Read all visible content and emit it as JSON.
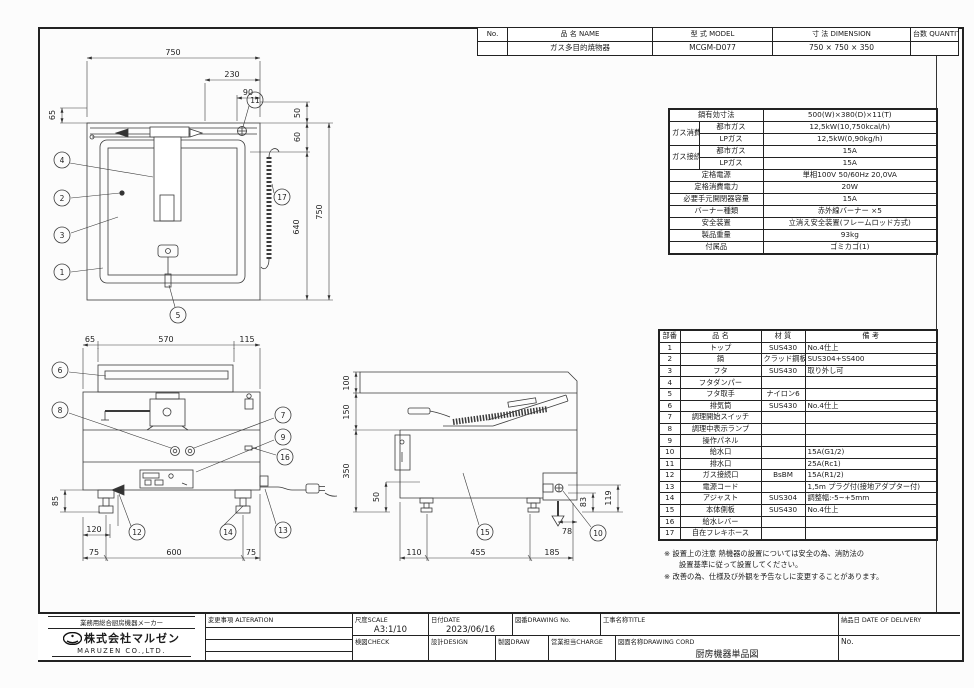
{
  "title_table": {
    "headers": {
      "no": "No.",
      "name": "品 名  NAME",
      "model": "型 式  MODEL",
      "dimension": "寸 法  DIMENSION",
      "quantity": "台数 QUANTITY"
    },
    "row": {
      "no": "",
      "name": "ガス多目的焼物器",
      "model": "MCGM-D077",
      "dimension": "750 × 750 × 350",
      "quantity": ""
    }
  },
  "spec": {
    "pan_size_label": "鍋有効寸法",
    "pan_size": "500(W)×380(D)×11(T)",
    "gas_consumption_label": "ガス消費量",
    "city_gas_label": "都市ガス",
    "lp_gas_label": "LPガス",
    "consumption_city": "12,5kW(10,750kcal/h)",
    "consumption_lp": "12,5kW(0,90kg/h)",
    "gas_connection_label": "ガス接続口",
    "connection_city_label": "都市ガス",
    "connection_lp_label": "LPガス",
    "connection_city": "15A",
    "connection_lp": "15A",
    "power_label": "定格電源",
    "power": "単相100V 50/60Hz 20,0VA",
    "power_consumption_label": "定格消費電力",
    "power_consumption": "20W",
    "breaker_label": "必要手元開閉器容量",
    "breaker": "15A",
    "burner_label": "バーナー種類",
    "burner": "赤外線バーナー ×5",
    "safety_label": "安全装置",
    "safety": "立消え安全装置(フレームロッド方式)",
    "weight_label": "製品重量",
    "weight": "93kg",
    "accessories_label": "付属品",
    "accessories": "ゴミカゴ(1)"
  },
  "parts": {
    "headers": {
      "no": "部番",
      "name": "品  名",
      "material": "材 質",
      "note": "備  考"
    },
    "rows": [
      {
        "no": "1",
        "name": "トップ",
        "material": "SUS430",
        "note": "No.4仕上"
      },
      {
        "no": "2",
        "name": "鍋",
        "material": "クラッド鋼板",
        "note": "SUS304+SS400"
      },
      {
        "no": "3",
        "name": "フタ",
        "material": "SUS430",
        "note": "取り外し可"
      },
      {
        "no": "4",
        "name": "フタダンパー",
        "material": "",
        "note": ""
      },
      {
        "no": "5",
        "name": "フタ取手",
        "material": "ナイロン6",
        "note": ""
      },
      {
        "no": "6",
        "name": "排気筒",
        "material": "SUS430",
        "note": "No.4仕上"
      },
      {
        "no": "7",
        "name": "調理開始スイッチ",
        "material": "",
        "note": ""
      },
      {
        "no": "8",
        "name": "調理中表示ランプ",
        "material": "",
        "note": ""
      },
      {
        "no": "9",
        "name": "操作パネル",
        "material": "",
        "note": ""
      },
      {
        "no": "10",
        "name": "給水口",
        "material": "",
        "note": "15A(G1/2)"
      },
      {
        "no": "11",
        "name": "排水口",
        "material": "",
        "note": "25A(Rc1)"
      },
      {
        "no": "12",
        "name": "ガス接続口",
        "material": "BsBM",
        "note": "15A(R1/2)"
      },
      {
        "no": "13",
        "name": "電源コード",
        "material": "",
        "note": "1,5m プラグ付(接地アダプター付)"
      },
      {
        "no": "14",
        "name": "アジャスト",
        "material": "SUS304",
        "note": "調整幅:-5~+5mm"
      },
      {
        "no": "15",
        "name": "本体側板",
        "material": "SUS430",
        "note": "No.4仕上"
      },
      {
        "no": "16",
        "name": "給水レバー",
        "material": "",
        "note": ""
      },
      {
        "no": "17",
        "name": "自在フレキホース",
        "material": "",
        "note": ""
      }
    ]
  },
  "notes": {
    "line1": "※ 設置上の注意 熱機器の設置については安全の為、消防法の",
    "line2": "設置基準に従って設置してください。",
    "line3": "※ 改善の為、仕様及び外観を予告なしに変更することがあります。"
  },
  "title_block": {
    "company_tagline": "業務用総合厨房機器メーカー",
    "company_name": "株式会社マルゼン",
    "company_name_en": "MARUZEN CO.,LTD.",
    "alteration_label": "変更事項  ALTERATION",
    "scale_label": "尺度SCALE",
    "scale_value": "A3:1/10",
    "date_label": "日付DATE",
    "date_value": "2023/06/16",
    "drawing_no_label": "図番DRAWING No.",
    "title_label": "工事名称TITLE",
    "delivery_label": "納品日  DATE OF DELIVERY",
    "check_label": "検図CHECK",
    "design_label": "設計DESIGN",
    "draw_label": "製図DRAW",
    "charge_label": "営業担当CHARGE",
    "drawing_name_label": "図面名称DRAWING CORD",
    "drawing_name_value": "厨房機器単品図",
    "no_label": "No."
  },
  "drawings": {
    "plan": {
      "dims": [
        "750",
        "230",
        "90",
        "65",
        "50",
        "60",
        "640",
        "750"
      ],
      "balloons": [
        "11",
        "4",
        "2",
        "3",
        "1",
        "17",
        "5"
      ]
    },
    "front": {
      "dims": [
        "65",
        "570",
        "115",
        "85",
        "120",
        "75",
        "600",
        "75"
      ],
      "balloons": [
        "6",
        "8",
        "7",
        "9",
        "16",
        "12",
        "14",
        "13"
      ]
    },
    "side": {
      "dims": [
        "100",
        "150",
        "350",
        "50",
        "110",
        "455",
        "185",
        "78",
        "83",
        "119"
      ],
      "balloons": [
        "15",
        "10"
      ]
    }
  }
}
